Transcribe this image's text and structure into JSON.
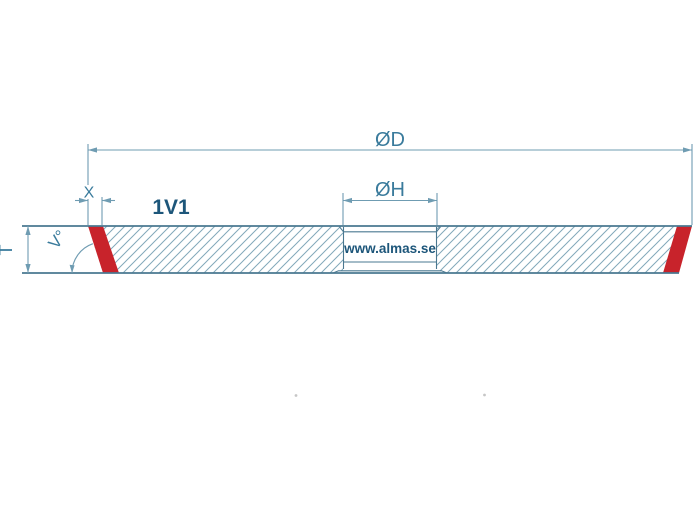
{
  "page": {
    "background": "#ffffff"
  },
  "drawing": {
    "type": "grinding-wheel-cross-section",
    "profile_label": "1V1",
    "watermark_text": "www.almas.se",
    "labels": {
      "outer_diameter": "ØD",
      "hole_diameter": "ØH",
      "abrasive_width": "X",
      "thickness": "T",
      "angle": "V°"
    },
    "colors": {
      "abrasive_red": "#c8232b",
      "outline_teal": "#4a7890",
      "dimension_teal": "#6f9cb2",
      "hatch_teal": "#82a8ba",
      "label_teal": "#3a7b9c",
      "brand_navy": "#1d567a"
    }
  }
}
